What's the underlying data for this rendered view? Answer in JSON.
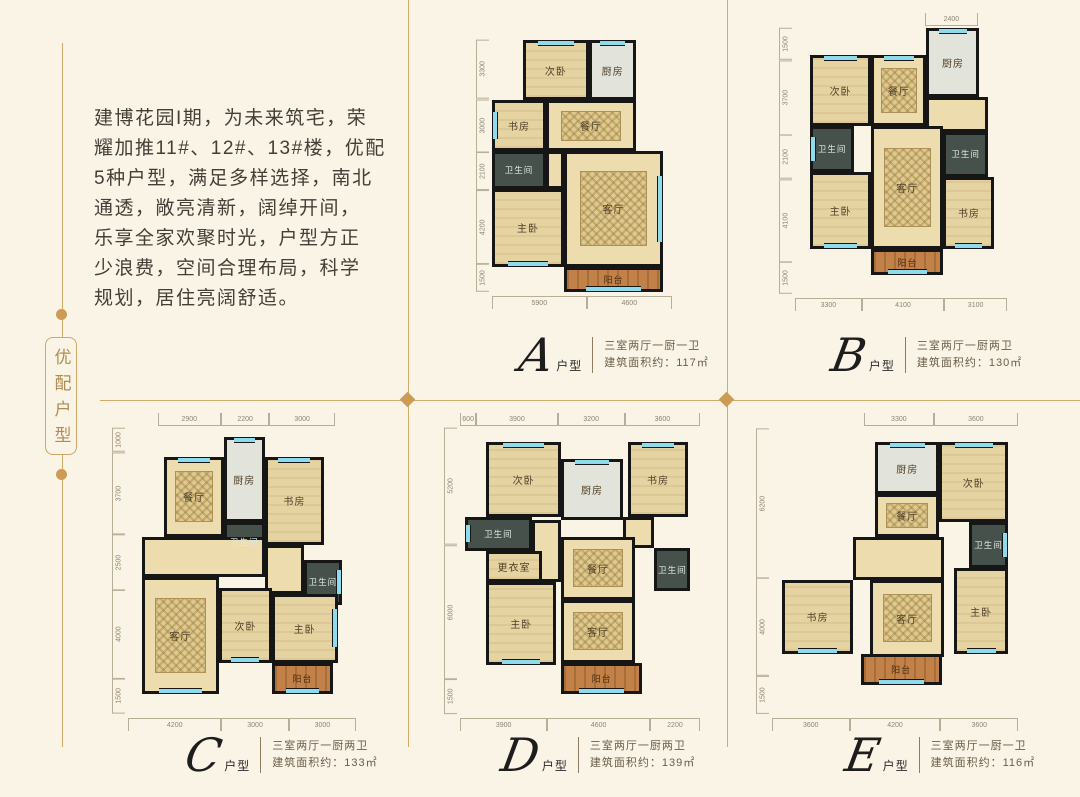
{
  "colors": {
    "background": "#faf4e6",
    "accent_gold": "#cc9b55",
    "wall": "#161616",
    "window_cyan": "#8edbee"
  },
  "side_tag": {
    "label": "优配户型"
  },
  "intro_lines": [
    "建博花园I期，为未来筑宅，荣",
    "耀加推11#、12#、13#楼，优配",
    "5种户型，满足多样选择，南北",
    "通透，敞亮清新，阔绰开间，",
    "乐享全家欢聚时光，户型方正",
    "少浪费，空间合理布局，科学",
    "规划，居住亮阔舒适。"
  ],
  "plans": [
    {
      "letter": "A",
      "suffix": "户型",
      "rooms_spec": "三室两厅一厨一卫",
      "area_spec": "建筑面积约：117㎡",
      "box": {
        "left": 492,
        "top": 40,
        "width": 180,
        "height": 252
      },
      "label_pos": {
        "left": 520,
        "top": 334
      },
      "rooms": [
        {
          "label": "次卧",
          "type": "bed",
          "x": 17,
          "y": 0,
          "w": 37,
          "h": 24,
          "win": "top"
        },
        {
          "label": "厨房",
          "type": "kitchen",
          "x": 54,
          "y": 0,
          "w": 26,
          "h": 24,
          "win": "top"
        },
        {
          "label": "书房",
          "type": "bed",
          "x": 0,
          "y": 24,
          "w": 30,
          "h": 20,
          "win": "left"
        },
        {
          "label": "餐厅",
          "type": "dining",
          "x": 30,
          "y": 24,
          "w": 50,
          "h": 20
        },
        {
          "label": "卫生间",
          "type": "bath",
          "x": 0,
          "y": 44,
          "w": 30,
          "h": 15
        },
        {
          "label": "",
          "type": "hall",
          "x": 30,
          "y": 44,
          "w": 10,
          "h": 15
        },
        {
          "label": "主卧",
          "type": "bed",
          "x": 0,
          "y": 59,
          "w": 40,
          "h": 31,
          "win": "bottom"
        },
        {
          "label": "客厅",
          "type": "living",
          "x": 40,
          "y": 44,
          "w": 55,
          "h": 46,
          "win": "right"
        },
        {
          "label": "阳台",
          "type": "balcony",
          "x": 40,
          "y": 90,
          "w": 55,
          "h": 10,
          "win": "bottom"
        }
      ],
      "dims_left": [
        {
          "t": "3300",
          "f": 33
        },
        {
          "t": "3000",
          "f": 30
        },
        {
          "t": "2100",
          "f": 21
        },
        {
          "t": "4200",
          "f": 42
        },
        {
          "t": "1500",
          "f": 15
        }
      ],
      "dims_bottom": [
        {
          "t": "5900",
          "f": 50
        },
        {
          "t": "4600",
          "f": 45
        }
      ],
      "dims_top": []
    },
    {
      "letter": "B",
      "suffix": "户型",
      "rooms_spec": "三室两厅一厨两卫",
      "area_spec": "建筑面积约：130㎡",
      "box": {
        "left": 795,
        "top": 28,
        "width": 212,
        "height": 266
      },
      "label_pos": {
        "left": 832,
        "top": 334
      },
      "rooms": [
        {
          "label": "厨房",
          "type": "kitchen",
          "x": 62,
          "y": 0,
          "w": 25,
          "h": 26,
          "win": "top"
        },
        {
          "label": "次卧",
          "type": "bed",
          "x": 7,
          "y": 10,
          "w": 29,
          "h": 27,
          "win": "top"
        },
        {
          "label": "餐厅",
          "type": "dining",
          "x": 36,
          "y": 10,
          "w": 26,
          "h": 27,
          "win": "top"
        },
        {
          "label": "",
          "type": "hall",
          "x": 62,
          "y": 26,
          "w": 29,
          "h": 13
        },
        {
          "label": "卫生间",
          "type": "bath",
          "x": 7,
          "y": 37,
          "w": 21,
          "h": 17,
          "win": "left"
        },
        {
          "label": "客厅",
          "type": "living",
          "x": 36,
          "y": 37,
          "w": 34,
          "h": 46
        },
        {
          "label": "卫生间",
          "type": "bath",
          "x": 70,
          "y": 39,
          "w": 21,
          "h": 17
        },
        {
          "label": "主卧",
          "type": "bed",
          "x": 7,
          "y": 54,
          "w": 29,
          "h": 29,
          "win": "bottom"
        },
        {
          "label": "书房",
          "type": "bed",
          "x": 70,
          "y": 56,
          "w": 24,
          "h": 27,
          "win": "bottom"
        },
        {
          "label": "阳台",
          "type": "balcony",
          "x": 36,
          "y": 83,
          "w": 34,
          "h": 10,
          "win": "bottom"
        }
      ],
      "dims_left": [
        {
          "t": "1500",
          "f": 15
        },
        {
          "t": "3700",
          "f": 37
        },
        {
          "t": "2100",
          "f": 21
        },
        {
          "t": "4100",
          "f": 41
        },
        {
          "t": "1500",
          "f": 15
        }
      ],
      "dims_bottom": [
        {
          "t": "3300",
          "f": 33
        },
        {
          "t": "4100",
          "f": 41
        },
        {
          "t": "3100",
          "f": 31
        }
      ],
      "dims_top": [
        {
          "t": "",
          "f": 62
        },
        {
          "t": "2400",
          "f": 24
        },
        {
          "t": "",
          "f": 14
        }
      ]
    },
    {
      "letter": "C",
      "suffix": "户型",
      "rooms_spec": "三室两厅一厨两卫",
      "area_spec": "建筑面积约：133㎡",
      "box": {
        "left": 128,
        "top": 428,
        "width": 228,
        "height": 286
      },
      "label_pos": {
        "left": 186,
        "top": 734
      },
      "rooms": [
        {
          "label": "餐厅",
          "type": "dining",
          "x": 16,
          "y": 10,
          "w": 26,
          "h": 28,
          "win": "top"
        },
        {
          "label": "厨房",
          "type": "kitchen",
          "x": 42,
          "y": 3,
          "w": 18,
          "h": 30,
          "win": "top"
        },
        {
          "label": "书房",
          "type": "bed",
          "x": 60,
          "y": 10,
          "w": 26,
          "h": 31,
          "win": "top"
        },
        {
          "label": "卫生间",
          "type": "bath",
          "x": 42,
          "y": 33,
          "w": 18,
          "h": 14
        },
        {
          "label": "",
          "type": "hall",
          "x": 6,
          "y": 38,
          "w": 54,
          "h": 14
        },
        {
          "label": "",
          "type": "hall",
          "x": 60,
          "y": 41,
          "w": 17,
          "h": 17
        },
        {
          "label": "卫生间",
          "type": "bath",
          "x": 77,
          "y": 46,
          "w": 17,
          "h": 16,
          "win": "right"
        },
        {
          "label": "客厅",
          "type": "living",
          "x": 6,
          "y": 52,
          "w": 34,
          "h": 41,
          "win": "bottom"
        },
        {
          "label": "次卧",
          "type": "bed",
          "x": 40,
          "y": 56,
          "w": 23,
          "h": 26,
          "win": "bottom"
        },
        {
          "label": "主卧",
          "type": "bed",
          "x": 63,
          "y": 58,
          "w": 29,
          "h": 24,
          "win": "right"
        },
        {
          "label": "阳台",
          "type": "balcony",
          "x": 63,
          "y": 82,
          "w": 27,
          "h": 11,
          "win": "bottom"
        }
      ],
      "dims_left": [
        {
          "t": "1000",
          "f": 10
        },
        {
          "t": "3700",
          "f": 37
        },
        {
          "t": "2500",
          "f": 25
        },
        {
          "t": "4000",
          "f": 40
        },
        {
          "t": "1500",
          "f": 15
        }
      ],
      "dims_bottom": [
        {
          "t": "4200",
          "f": 42
        },
        {
          "t": "3000",
          "f": 30
        },
        {
          "t": "3000",
          "f": 30
        }
      ],
      "dims_top": [
        {
          "t": "",
          "f": 14
        },
        {
          "t": "2900",
          "f": 29
        },
        {
          "t": "2200",
          "f": 22
        },
        {
          "t": "3000",
          "f": 30
        },
        {
          "t": "",
          "f": 10
        }
      ]
    },
    {
      "letter": "D",
      "suffix": "户型",
      "rooms_spec": "三室两厅一厨两卫",
      "area_spec": "建筑面积约：139㎡",
      "box": {
        "left": 460,
        "top": 428,
        "width": 240,
        "height": 286
      },
      "label_pos": {
        "left": 502,
        "top": 734
      },
      "rooms": [
        {
          "label": "次卧",
          "type": "bed",
          "x": 11,
          "y": 5,
          "w": 31,
          "h": 26,
          "win": "top"
        },
        {
          "label": "厨房",
          "type": "kitchen",
          "x": 42,
          "y": 11,
          "w": 26,
          "h": 21,
          "win": "top"
        },
        {
          "label": "书房",
          "type": "bed",
          "x": 70,
          "y": 5,
          "w": 25,
          "h": 26,
          "win": "top"
        },
        {
          "label": "卫生间",
          "type": "bath",
          "x": 2,
          "y": 31,
          "w": 28,
          "h": 12,
          "win": "left"
        },
        {
          "label": "",
          "type": "hall",
          "x": 30,
          "y": 32,
          "w": 12,
          "h": 22
        },
        {
          "label": "",
          "type": "hall",
          "x": 68,
          "y": 31,
          "w": 13,
          "h": 11
        },
        {
          "label": "更衣室",
          "type": "bed",
          "x": 11,
          "y": 43,
          "w": 23,
          "h": 11
        },
        {
          "label": "餐厅",
          "type": "dining",
          "x": 42,
          "y": 38,
          "w": 31,
          "h": 22
        },
        {
          "label": "卫生间",
          "type": "bath",
          "x": 81,
          "y": 42,
          "w": 15,
          "h": 15
        },
        {
          "label": "主卧",
          "type": "bed",
          "x": 11,
          "y": 54,
          "w": 29,
          "h": 29,
          "win": "bottom"
        },
        {
          "label": "客厅",
          "type": "living",
          "x": 42,
          "y": 60,
          "w": 31,
          "h": 22
        },
        {
          "label": "阳台",
          "type": "balcony",
          "x": 42,
          "y": 82,
          "w": 34,
          "h": 11,
          "win": "bottom"
        }
      ],
      "dims_left": [
        {
          "t": "5200",
          "f": 52
        },
        {
          "t": "6000",
          "f": 60
        },
        {
          "t": "1500",
          "f": 15
        }
      ],
      "dims_bottom": [
        {
          "t": "3900",
          "f": 39
        },
        {
          "t": "4600",
          "f": 46
        },
        {
          "t": "2200",
          "f": 22
        }
      ],
      "dims_top": [
        {
          "t": "600",
          "f": 7
        },
        {
          "t": "3900",
          "f": 39
        },
        {
          "t": "3200",
          "f": 32
        },
        {
          "t": "3600",
          "f": 36
        }
      ]
    },
    {
      "letter": "E",
      "suffix": "户型",
      "rooms_spec": "三室两厅一厨一卫",
      "area_spec": "建筑面积约：116㎡",
      "box": {
        "left": 772,
        "top": 428,
        "width": 246,
        "height": 286
      },
      "label_pos": {
        "left": 846,
        "top": 734
      },
      "rooms": [
        {
          "label": "厨房",
          "type": "kitchen",
          "x": 42,
          "y": 5,
          "w": 26,
          "h": 18,
          "win": "top"
        },
        {
          "label": "次卧",
          "type": "bed",
          "x": 68,
          "y": 5,
          "w": 28,
          "h": 28,
          "win": "top"
        },
        {
          "label": "餐厅",
          "type": "dining",
          "x": 42,
          "y": 23,
          "w": 26,
          "h": 15
        },
        {
          "label": "",
          "type": "hall",
          "x": 33,
          "y": 38,
          "w": 37,
          "h": 15
        },
        {
          "label": "卫生间",
          "type": "bath",
          "x": 80,
          "y": 33,
          "w": 16,
          "h": 16,
          "win": "right"
        },
        {
          "label": "书房",
          "type": "bed",
          "x": 4,
          "y": 53,
          "w": 29,
          "h": 26,
          "win": "bottom"
        },
        {
          "label": "客厅",
          "type": "living",
          "x": 40,
          "y": 53,
          "w": 30,
          "h": 27
        },
        {
          "label": "主卧",
          "type": "bed",
          "x": 74,
          "y": 49,
          "w": 22,
          "h": 30,
          "win": "bottom"
        },
        {
          "label": "阳台",
          "type": "balcony",
          "x": 36,
          "y": 79,
          "w": 33,
          "h": 11,
          "win": "bottom"
        }
      ],
      "dims_left": [
        {
          "t": "6200",
          "f": 62
        },
        {
          "t": "4000",
          "f": 40
        },
        {
          "t": "1500",
          "f": 15
        }
      ],
      "dims_bottom": [
        {
          "t": "3600",
          "f": 34
        },
        {
          "t": "4200",
          "f": 40
        },
        {
          "t": "3600",
          "f": 34
        }
      ],
      "dims_top": [
        {
          "t": "",
          "f": 38
        },
        {
          "t": "3300",
          "f": 28
        },
        {
          "t": "3600",
          "f": 34
        }
      ]
    }
  ]
}
